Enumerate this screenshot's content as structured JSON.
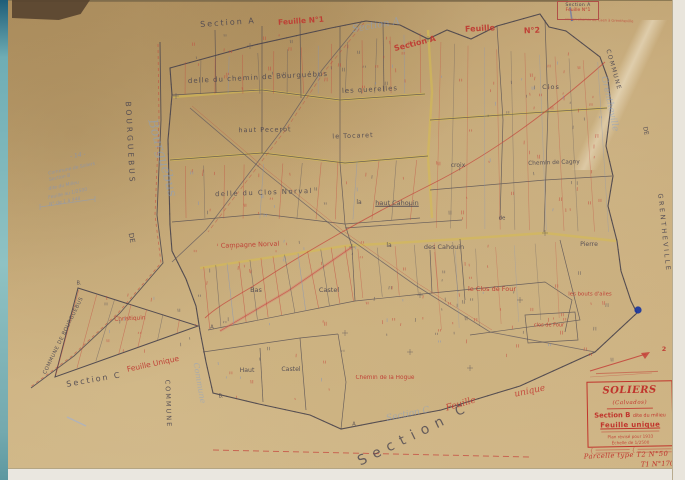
{
  "corner_box": {
    "line1": "Section A",
    "line2": "Feuille N°1"
  },
  "title_block": {
    "title": "SOLIERS",
    "subtitle": "(Calvados)",
    "section": "Section B",
    "section_sub": "dite du milieu",
    "feuille": "Feuille unique",
    "revision": "Plan révisé pour 1933",
    "scale": "Échelle de 1/2500"
  },
  "parcel_note": {
    "line1": "Parcelle type  T2  N°50",
    "line2": "T1  N°170"
  },
  "annotations": {
    "arrow_label": "2"
  },
  "colors": {
    "red": "#bf3a32",
    "ink": "#4a4550",
    "pencil_blue": "#7d92c0",
    "road_yellow": "#d9c04f",
    "paper": "#c9ac7a",
    "blue_ink": "#16339e"
  },
  "map": {
    "labels": [
      {
        "n": "label-section-a-top",
        "t": "Section A",
        "x": 220,
        "y": 23,
        "r": -4,
        "s": 8,
        "c": "ink",
        "ls": 2
      },
      {
        "n": "label-feuille-n1",
        "t": "Feuille N°1",
        "x": 293,
        "y": 21,
        "r": -4,
        "s": 7.5,
        "c": "red",
        "b": 1
      },
      {
        "n": "label-pencil-section-a",
        "t": "Section A",
        "x": 368,
        "y": 26,
        "r": -10,
        "s": 10,
        "c": "pencil-cursive"
      },
      {
        "n": "label-section-a-red",
        "t": "Section A",
        "x": 407,
        "y": 44,
        "r": -14,
        "s": 8,
        "c": "red",
        "b": 1
      },
      {
        "n": "label-feuille-red",
        "t": "Feuille",
        "x": 472,
        "y": 29,
        "r": -3,
        "s": 8,
        "c": "red",
        "b": 1
      },
      {
        "n": "label-feuille-n2-red",
        "t": "N°2",
        "x": 524,
        "y": 31,
        "r": -3,
        "s": 8,
        "c": "red",
        "b": 1
      },
      {
        "n": "label-ancien-chemin",
        "t": "ancien chemin de Caen à Grentheville",
        "x": 591,
        "y": 21,
        "r": 2,
        "s": 3.6,
        "c": "red",
        "o": 0.7
      },
      {
        "n": "label-commune-de-bourguebus",
        "t": "COMMUNE  DE  BOURGUEBUS",
        "x": 56,
        "y": 336,
        "r": -64,
        "s": 5.2,
        "c": "ink",
        "ls": 0.5
      },
      {
        "n": "label-de-west",
        "t": "DE",
        "x": 123,
        "y": 238,
        "r": 80,
        "s": 7,
        "c": "ink"
      },
      {
        "n": "label-bourguebus-west",
        "t": "BOURGUEBUS",
        "x": 122,
        "y": 143,
        "r": 87,
        "s": 7.5,
        "c": "ink",
        "ls": 3
      },
      {
        "n": "label-bourguebus-cursive",
        "t": "Bourguébus",
        "x": 154,
        "y": 158,
        "r": 75,
        "s": 13,
        "c": "pencil-cursive"
      },
      {
        "n": "label-note-14",
        "t": "- 14 -",
        "x": 70,
        "y": 156,
        "r": -10,
        "s": 6,
        "c": "pencil"
      },
      {
        "n": "label-note-commune-soliers",
        "t": "Commune de Soliers",
        "x": 64,
        "y": 170,
        "r": -12,
        "s": 4.6,
        "c": "pencil"
      },
      {
        "n": "label-note-section-b",
        "t": "Section B",
        "x": 52,
        "y": 179,
        "r": -12,
        "s": 4.6,
        "c": "pencil"
      },
      {
        "n": "label-note-dite-du-milieu",
        "t": "dite du Milieu",
        "x": 56,
        "y": 187,
        "r": -12,
        "s": 4.6,
        "c": "pencil"
      },
      {
        "n": "label-note-feuille-2500",
        "t": "Feuille au 1/2500",
        "x": 60,
        "y": 195,
        "r": -12,
        "s": 4.6,
        "c": "pencil"
      },
      {
        "n": "label-note-numeros",
        "t": "N° de 1 à 348",
        "x": 57,
        "y": 203,
        "r": -11,
        "s": 4.6,
        "c": "pencil"
      },
      {
        "n": "label-delle-chemin-bourguebus",
        "t": "delle du chemin de Bourguébus",
        "x": 250,
        "y": 78,
        "r": -3,
        "s": 7,
        "c": "ink",
        "ls": 1
      },
      {
        "n": "label-les-querelles",
        "t": "les querelles",
        "x": 362,
        "y": 90,
        "r": -3,
        "s": 6.8,
        "c": "ink",
        "ls": 1
      },
      {
        "n": "label-haut-pecerot",
        "t": "haut Pecerot",
        "x": 257,
        "y": 130,
        "r": -1,
        "s": 6.5,
        "c": "ink",
        "ls": 1
      },
      {
        "n": "label-le-tocaret",
        "t": "le Tocaret",
        "x": 345,
        "y": 136,
        "r": -2,
        "s": 6.5,
        "c": "ink",
        "ls": 1
      },
      {
        "n": "label-delle-clos-norval",
        "t": "delle du Clos Norval",
        "x": 256,
        "y": 193,
        "r": -2,
        "s": 6.8,
        "c": "ink",
        "ls": 1.5
      },
      {
        "n": "label-la-1",
        "t": "la",
        "x": 351,
        "y": 203,
        "s": 6,
        "c": "ink"
      },
      {
        "n": "label-haut-cahouin",
        "t": "haut Cahouin",
        "x": 389,
        "y": 203,
        "s": 6.5,
        "c": "ink",
        "u": 1
      },
      {
        "n": "label-la-2",
        "t": "la",
        "x": 381,
        "y": 246,
        "s": 6,
        "c": "ink"
      },
      {
        "n": "label-des-cahouin",
        "t": "des Cahouin",
        "x": 436,
        "y": 247,
        "s": 6.5,
        "c": "ink"
      },
      {
        "n": "label-croix",
        "t": "croix",
        "x": 450,
        "y": 166,
        "s": 6,
        "c": "ink"
      },
      {
        "n": "label-clos",
        "t": "Clos",
        "x": 543,
        "y": 87,
        "s": 6.5,
        "c": "ink",
        "ls": 1
      },
      {
        "n": "label-chemin-de-cagny",
        "t": "Chemin de Cagny",
        "x": 546,
        "y": 164,
        "r": -2,
        "s": 5.8,
        "c": "ink"
      },
      {
        "n": "label-de-small",
        "t": "de",
        "x": 494,
        "y": 219,
        "s": 5.5,
        "c": "ink"
      },
      {
        "n": "label-pierre",
        "t": "Pierre",
        "x": 581,
        "y": 245,
        "s": 6.2,
        "c": "ink"
      },
      {
        "n": "label-bas",
        "t": "Bas",
        "x": 248,
        "y": 290,
        "s": 6.5,
        "c": "ink"
      },
      {
        "n": "label-castel-1",
        "t": "Castel",
        "x": 321,
        "y": 290,
        "s": 6.5,
        "c": "ink"
      },
      {
        "n": "label-haut",
        "t": "Haut",
        "x": 239,
        "y": 371,
        "s": 6.2,
        "c": "ink"
      },
      {
        "n": "label-castel-2",
        "t": "Castel",
        "x": 283,
        "y": 370,
        "s": 6.2,
        "c": "ink"
      },
      {
        "n": "label-section-c-small",
        "t": "Section C",
        "x": 86,
        "y": 380,
        "r": -10,
        "s": 8,
        "c": "ink",
        "ls": 2
      },
      {
        "n": "label-section-c-big",
        "t": "Section",
        "x": 396,
        "y": 440,
        "r": -26,
        "s": 14,
        "c": "ink",
        "ls": 7,
        "o": 0.8
      },
      {
        "n": "label-c-big",
        "t": "C",
        "x": 452,
        "y": 411,
        "r": -20,
        "s": 13,
        "c": "ink",
        "o": 0.8
      },
      {
        "n": "label-campagne-norval",
        "t": "Campagne Norval",
        "x": 242,
        "y": 245,
        "r": -2,
        "s": 6.5,
        "c": "red"
      },
      {
        "n": "label-christiquin",
        "t": "Christiquin",
        "x": 122,
        "y": 320,
        "r": -3,
        "s": 5.8,
        "c": "red"
      },
      {
        "n": "label-feuille-unique-left",
        "t": "Feuille Unique",
        "x": 145,
        "y": 364,
        "r": -12,
        "s": 7.5,
        "c": "red"
      },
      {
        "n": "label-le-clos-de-four",
        "t": "le Clos de Four",
        "x": 484,
        "y": 289,
        "s": 6.5,
        "c": "red"
      },
      {
        "n": "label-les-bouts-d-ailes",
        "t": "les bouts d'ailes",
        "x": 582,
        "y": 295,
        "s": 5.4,
        "c": "red"
      },
      {
        "n": "label-clos-de-four-small",
        "t": "clos de Four",
        "x": 541,
        "y": 326,
        "s": 5,
        "c": "red"
      },
      {
        "n": "label-chemin-de-la-hogue",
        "t": "Chemin de la Hogue",
        "x": 377,
        "y": 379,
        "s": 5.8,
        "c": "red"
      },
      {
        "n": "label-feuille-cursive",
        "t": "Feuille",
        "x": 453,
        "y": 405,
        "r": -16,
        "s": 9,
        "c": "red-cursive"
      },
      {
        "n": "label-unique-cursive",
        "t": "unique",
        "x": 522,
        "y": 392,
        "r": -12,
        "s": 9,
        "c": "red-cursive"
      },
      {
        "n": "label-section-c-pencil",
        "t": "Section C",
        "x": 400,
        "y": 415,
        "r": -12,
        "s": 9,
        "c": "pencil-cursive"
      },
      {
        "n": "label-commune-right",
        "t": "COMMUNE",
        "x": 605,
        "y": 70,
        "r": 74,
        "s": 6,
        "c": "ink",
        "ls": 1.5
      },
      {
        "n": "label-grentheville-cursive",
        "t": "Grentheville",
        "x": 601,
        "y": 104,
        "r": 78,
        "s": 9,
        "c": "pencil-cursive"
      },
      {
        "n": "label-de-right",
        "t": "DE",
        "x": 637,
        "y": 131,
        "r": 78,
        "s": 6,
        "c": "ink"
      },
      {
        "n": "label-grentheville-right",
        "t": "GRENTHEVILLE",
        "x": 656,
        "y": 233,
        "r": 84,
        "s": 6.5,
        "c": "ink",
        "ls": 2.5
      },
      {
        "n": "label-commune-bottom-cursive",
        "t": "Commune",
        "x": 191,
        "y": 383,
        "r": 80,
        "s": 8,
        "c": "pencil-cursive"
      },
      {
        "n": "label-commune-bottom",
        "t": "COMMUNE",
        "x": 160,
        "y": 404,
        "r": 88,
        "s": 6.5,
        "c": "ink",
        "ls": 2
      },
      {
        "n": "label-point-b1",
        "t": "B.",
        "x": 71,
        "y": 284,
        "s": 5,
        "c": "ink"
      },
      {
        "n": "label-point-a1",
        "t": "A",
        "x": 204,
        "y": 328,
        "s": 5,
        "c": "ink"
      },
      {
        "n": "label-point-b2",
        "t": "B.",
        "x": 213,
        "y": 397,
        "s": 5,
        "c": "ink"
      },
      {
        "n": "label-point-a2",
        "t": "A",
        "x": 346,
        "y": 425,
        "s": 5,
        "c": "ink"
      },
      {
        "n": "label-arrow-2",
        "t": "2",
        "x": 656,
        "y": 349,
        "s": 6.5,
        "c": "red",
        "b": 1
      }
    ]
  }
}
